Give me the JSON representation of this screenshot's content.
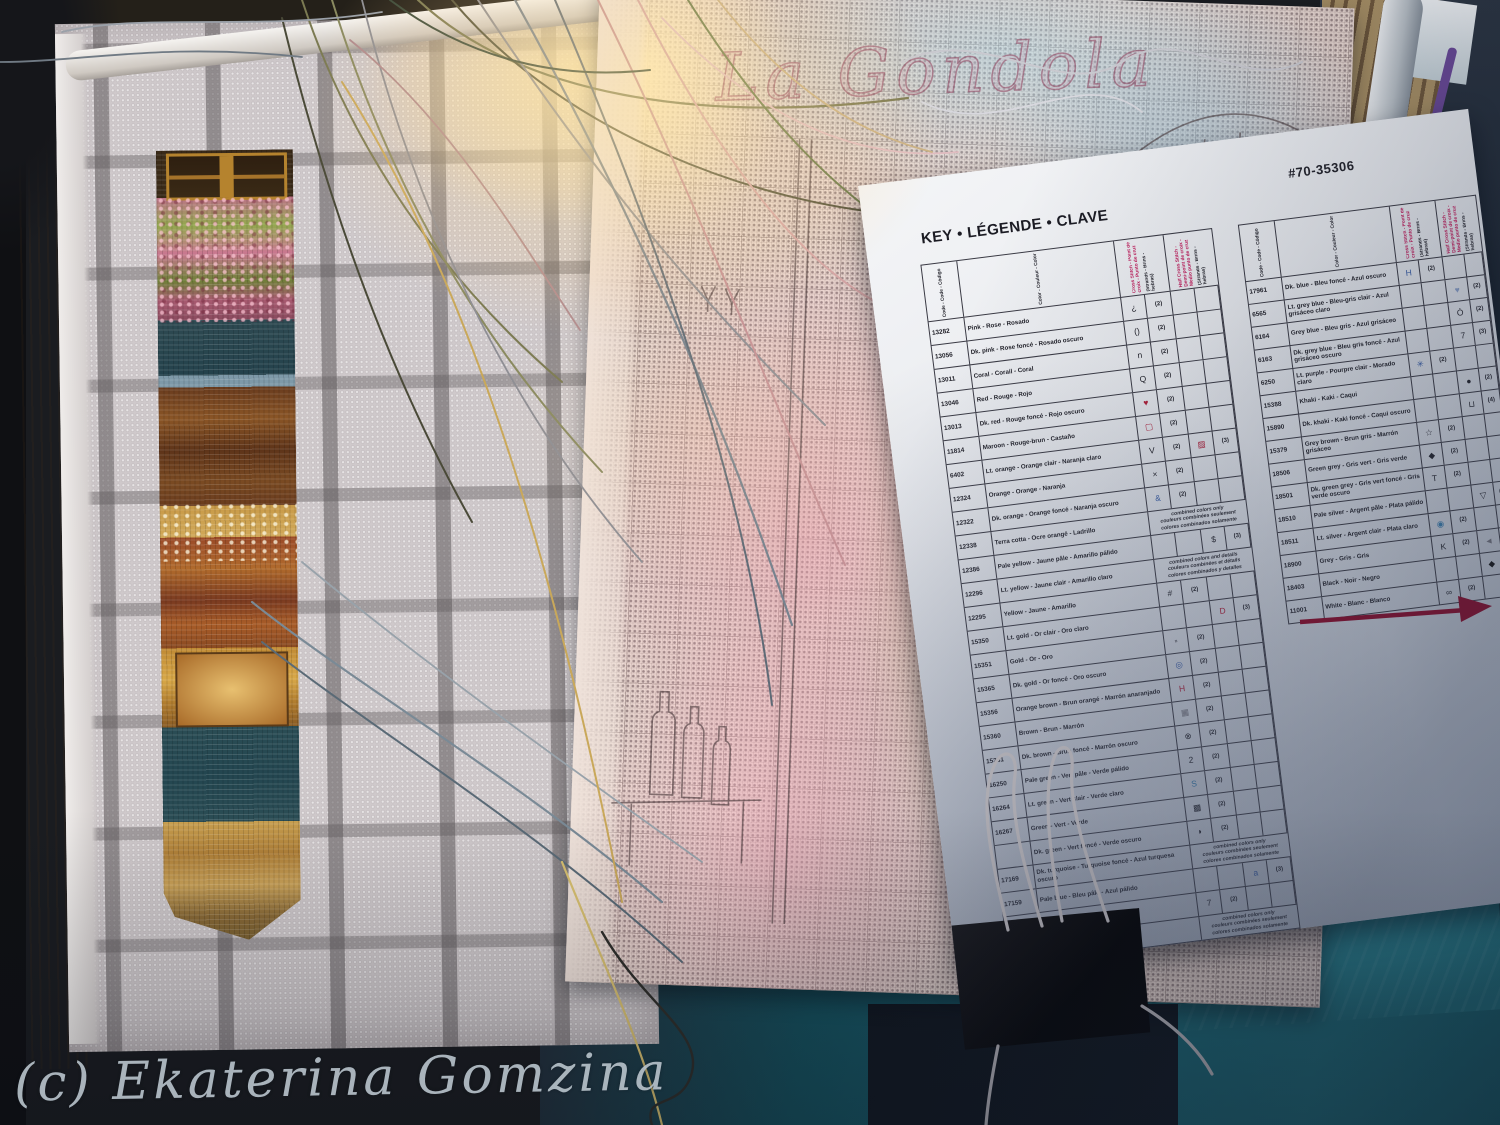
{
  "photo": {
    "watermark": "(c) Ekaterina Gomzina"
  },
  "pattern_chart": {
    "lettering": "La Gondola"
  },
  "palette": {
    "arrow": "#871433",
    "header_accent": "#c01858",
    "paper": "#e9ebef",
    "aida_fabric": "#cfc9cb",
    "teal_fabric": "#1d6b77",
    "binder_clip": "#0a0a0c",
    "wood_frame": "#c2a268"
  },
  "key_sheet": {
    "product_number": "#70-35306",
    "title": "KEY • LÉGENDE • CLAVE",
    "sheet_label": "SHEET 3 OF",
    "column_headers": {
      "code": "Code - Code - Código",
      "color": "Color - Couleur - Color",
      "cross_stitch": "Cross Stitch - Point de croix - Punto de cruz",
      "cross_strands": "(Strands - Brins - hebras)",
      "half_cross": "Half Cross Stitch - Demi-point de croix - Medio punto de cruz",
      "half_strands": "(Strands - Brins - hebras)"
    },
    "left_table": [
      {
        "code": "13282",
        "color": "Pink - Rose - Rosado",
        "cs": "¿",
        "csn": "(2)"
      },
      {
        "code": "13056",
        "color": "Dk. pink - Rose foncé - Rosado oscuro",
        "cs": "()",
        "csn": "(2)"
      },
      {
        "code": "13011",
        "color": "Coral - Corail - Coral",
        "cs": "n",
        "csn": "(2)"
      },
      {
        "code": "13046",
        "color": "Red - Rouge - Rojo",
        "cs": "Q",
        "csn": "(2)"
      },
      {
        "code": "13013",
        "color": "Dk. red - Rouge foncé - Rojo oscuro",
        "cs": "♥",
        "cs_color": "#b0203a",
        "csn": "(2)"
      },
      {
        "code": "11814",
        "color": "Maroon - Rouge-brun - Castaño",
        "cs": "▢",
        "cs_color": "#b0203a",
        "csn": "(2)"
      },
      {
        "code": "6402",
        "color": "Lt. orange - Orange clair - Naranja claro",
        "cs": "V",
        "csn": "(2)",
        "hc": "▨",
        "hc_color": "#b0203a",
        "hcn": "(3)"
      },
      {
        "code": "12324",
        "color": "Orange - Orange - Naranja",
        "cs": "×",
        "csn": "(2)"
      },
      {
        "code": "12322",
        "color": "Dk. orange - Orange foncé - Naranja oscuro",
        "cs": "&",
        "cs_color": "#3a5fa8",
        "csn": "(2)"
      },
      {
        "code": "12338",
        "color": "Terra cotta - Ocre orangé - Ladrillo",
        "note": [
          "combined colors only",
          "couleurs combinées seulement",
          "colores combinados solamente"
        ]
      },
      {
        "code": "12386",
        "color": "Pale yellow - Jaune pâle - Amarillo pálido",
        "hc": "$",
        "hcn": "(3)"
      },
      {
        "code": "12296",
        "color": "Lt. yellow - Jaune clair - Amarillo claro",
        "note": [
          "combined colors and details",
          "couleurs combinées et détails",
          "colores combinados y detalles"
        ]
      },
      {
        "code": "12295",
        "color": "Yellow - Jaune - Amarillo",
        "cs": "#",
        "csn": "(2)"
      },
      {
        "code": "15350",
        "color": "Lt. gold - Or clair - Oro claro",
        "hc": "D",
        "hc_color": "#b0203a",
        "hcn": "(3)"
      },
      {
        "code": "15351",
        "color": "Gold - Or - Oro",
        "cs": "▫",
        "csn": "(2)"
      },
      {
        "code": "15365",
        "color": "Dk. gold - Or foncé - Oro oscuro",
        "cs": "◎",
        "cs_color": "#3a5fa8",
        "csn": "(2)"
      },
      {
        "code": "15356",
        "color": "Orange brown - Brun orangé - Marrón anaranjado",
        "cs": "H",
        "cs_color": "#b0203a",
        "csn": "(2)"
      },
      {
        "code": "15360",
        "color": "Brown - Brun - Marrón",
        "cs": "▦",
        "cs_color": "#777780",
        "csn": "(2)"
      },
      {
        "code": "15381",
        "color": "Dk. brown - Brun foncé - Marrón oscuro",
        "cs": "⊗",
        "csn": "(2)"
      },
      {
        "code": "16250",
        "color": "Pale green - Vert pâle - Verde pálido",
        "cs": "2",
        "csn": "(2)"
      },
      {
        "code": "16264",
        "color": "Lt. green - Vert clair - Verde claro",
        "cs": "S",
        "cs_color": "#3a7fb0",
        "csn": "(2)"
      },
      {
        "code": "16267",
        "color": "Green - Vert - Verde",
        "cs": "▩",
        "csn": "(2)"
      },
      {
        "code": "",
        "color": "Dk. green - Vert foncé - Verde oscuro",
        "cs": "◗",
        "csn": "(2)"
      },
      {
        "code": "17169",
        "color": "Dk. turquoise - Turquoise foncé - Azul turquesa oscuro",
        "note": [
          "combined colors only",
          "couleurs combinées seulement",
          "colores combinados solamente"
        ]
      },
      {
        "code": "17159",
        "color": "Pale blue - Bleu pâle - Azul pálido",
        "hc": "a",
        "hc_color": "#3a5fa8",
        "hcn": "(3)"
      },
      {
        "code": "171",
        "color": "Lt. blue - Bleu clair - Azul claro",
        "cs": "7",
        "csn": "(2)"
      },
      {
        "code": "17180",
        "color": "Blue - Bleu - Azul",
        "note": [
          "combined colors only",
          "couleurs combinées seulement",
          "colores combinados solamente"
        ]
      }
    ],
    "right_table": [
      {
        "code": "17961",
        "color": "Dk. blue - Bleu foncé - Azul oscuro",
        "cs": "H",
        "cs_color": "#3a5fa8",
        "csn": "(2)"
      },
      {
        "code": "6565",
        "color": "Lt. grey blue - Bleu-gris clair - Azul grisáceo claro",
        "hc": "♥",
        "hc_color": "#8aa0c8",
        "hcn": "(2)"
      },
      {
        "code": "6164",
        "color": "Grey blue - Bleu gris - Azul grisáceo",
        "hc": "Ó",
        "hcn": "(2)"
      },
      {
        "code": "6163",
        "color": "Dk. grey blue - Bleu gris foncé - Azul grisáceo oscuro",
        "hc": "7",
        "hcn": "(3)"
      },
      {
        "code": "6250",
        "color": "Lt. purple - Pourpre clair - Morado claro",
        "cs": "✳",
        "cs_color": "#3a5fa8",
        "csn": "(2)"
      },
      {
        "code": "15388",
        "color": "Khaki - Kaki - Caqui",
        "hc": "●",
        "hcn": "(2)"
      },
      {
        "code": "15890",
        "color": "Dk. khaki - Kaki foncé - Caqui oscuro",
        "hc": "⊔",
        "hcn": "(4)"
      },
      {
        "code": "15379",
        "color": "Grey brown - Brun gris - Marrón grisáceo",
        "cs": "☆",
        "csn": "(2)"
      },
      {
        "code": "18506",
        "color": "Green grey - Gris vert - Gris verde",
        "cs": "◆",
        "csn": "(2)"
      },
      {
        "code": "18501",
        "color": "Dk. green grey - Gris vert foncé - Gris verde oscuro",
        "cs": "T",
        "csn": "(2)"
      },
      {
        "code": "18510",
        "color": "Pale silver - Argent pâle - Plata pálido",
        "hc": "▽",
        "hcn": "(2)"
      },
      {
        "code": "18511",
        "color": "Lt. silver - Argent clair - Plata claro",
        "cs": "◉",
        "cs_color": "#3a7fb0",
        "csn": "(2)"
      },
      {
        "code": "18900",
        "color": "Grey - Gris - Gris",
        "cs": "K",
        "csn": "(2)",
        "hc": "◄",
        "hc_color": "#777780",
        "hcn": "(3)"
      },
      {
        "code": "18403",
        "color": "Black - Noir - Negro",
        "hc": "◆",
        "hc_color": "#111111",
        "hcn": "(4)"
      },
      {
        "code": "11001",
        "color": "White - Blanc - Blanco",
        "cs": "∞",
        "csn": "(2)"
      }
    ]
  }
}
